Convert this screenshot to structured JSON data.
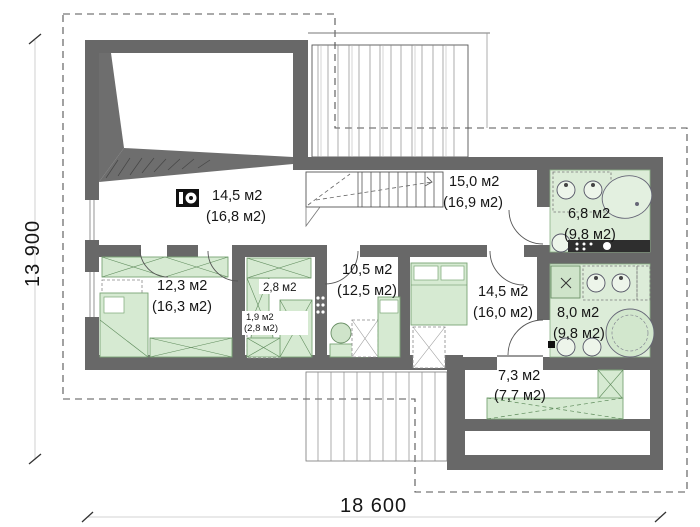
{
  "plan": {
    "title": "second-floor-plan",
    "dimensions": {
      "width_label": "18 600",
      "height_label": "13 900"
    },
    "rooms": [
      {
        "id": "laundry-room",
        "area": "14,5 м2",
        "total": "(16,8 м2)"
      },
      {
        "id": "hall-landing",
        "area": "15,0 м2",
        "total": "(16,9 м2)"
      },
      {
        "id": "bathroom-top",
        "area": "6,8 м2",
        "total": "(9,8 м2)"
      },
      {
        "id": "bedroom-left",
        "area": "12,3 м2",
        "total": "(16,3 м2)"
      },
      {
        "id": "closet-upper",
        "area": "2,8 м2",
        "total": ""
      },
      {
        "id": "closet-lower",
        "area": "1,9 м2",
        "total": "(2,8 м2)"
      },
      {
        "id": "corridor",
        "area": "10,5 м2",
        "total": "(12,5 м2)"
      },
      {
        "id": "bedroom-right",
        "area": "14,5 м2",
        "total": "(16,0 м2)"
      },
      {
        "id": "bathroom-bottom",
        "area": "8,0 м2",
        "total": "(9,8 м2)"
      },
      {
        "id": "wardrobe-room",
        "area": "7,3 м2",
        "total": "(7,7 м2)"
      }
    ],
    "icons": [
      {
        "name": "washing-machine-icon"
      }
    ],
    "colors": {
      "wall": "#686868",
      "furniture_green": "#d6ead2",
      "bath_floor_green": "#dcecd8",
      "counter_dark": "#2e2e2e",
      "roof_dash": "#555555"
    }
  }
}
